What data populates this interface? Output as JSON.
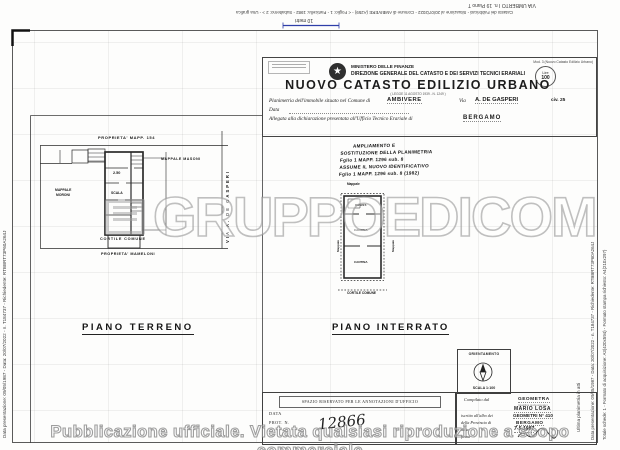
{
  "colors": {
    "scale_bar_blue": "#2e3ea8",
    "ink": "#1c1c1c",
    "watermark_gray": "#9a9a9a"
  },
  "icons": {
    "emblem_star": "★"
  },
  "margins": {
    "top_line1": "VIA UMBERTO I n. 19 Piano T",
    "top_line2": "Catasto dei Fabbricati - Situazione al 20/07/2022 - Comune di AMBIVERE (A259) - < Foglio: 1 - Particella: 1982 - Subalterno: 2 > - Una grafica",
    "scale_label": "10 metri",
    "left_vertical": "Data presentazione: 09/05/1987 - Data: 20/07/2022 - n. T184737 - Richiedente: RTBBRT73P60A264J",
    "right_vertical_1": "Ultima planimetria in atti",
    "right_vertical_2": "Data presentazione: 09/05/1987 - Data: 20/07/2022 - n. T184737 - Richiedente: RTBBRT73P60A264J",
    "right_vertical_3": "Totale schede: 1 - Formato di acquisizione: A3(420x594) - Formato stampa richiesto: A4(210x297)"
  },
  "header": {
    "ministry": "MINISTERO DELLE FINANZE",
    "direction": "DIREZIONE GENERALE DEL CATASTO E DEI SERVIZI TECNICI ERARIALI",
    "title": "NUOVO CATASTO EDILIZIO URBANO",
    "law_note": "( LEGGE 11 AGOSTO 1939 - N. 1249 )",
    "mod_label": "Mod. 3 (Nuovo Catasto Edilizio Urbano)",
    "lire_label": "Lire",
    "lire_value": "100",
    "f1_label": "Planimetria dell'immobile situato nel Comune di",
    "f1_comune": "AMBIVERE",
    "f1_via_label": "Via",
    "f1_via": "A. DE GASPERI",
    "f1_civ": "civ. 25",
    "f2_label": "Data",
    "f3_label": "Allegata alla dichiarazione presentata all'Ufficio Tecnico Erariale di",
    "f3_value": "BERGAMO"
  },
  "note": {
    "line1": "AMPLIAMENTO  E",
    "line2": "SOSTITUZIONE DELLA PLANIMETRIA",
    "line3": "Fglio 1   MAPP. 1296   sub. 8",
    "line4": "ASSUME IL NUOVO IDENTIFICATIVO",
    "line5": "Fglio 1   MAPP. 1296   sub. 8   (1982)"
  },
  "plan_terreno": {
    "top_label": "PROPRIETA' MAPP. 154",
    "right_label": "MAPPALE MASONI",
    "left_label_1": "MAPPALE",
    "left_label_2": "MORONI",
    "room_height": "2.50",
    "stair_label": "SCALA",
    "courtyard": "CORTILE COMUNE",
    "bottom_label": "PROPRIETA'  MAMELONI",
    "street": "VIA  A.  DE  GASPERI",
    "floor": "PIANO  TERRENO"
  },
  "plan_interrato": {
    "top_label": "Mappale",
    "room_top": "RIPOST.",
    "room_mid": "CANTINA",
    "room_low": "CANTINA",
    "side_left": "Mappale",
    "side_right": "Mappale",
    "bottom_label": "CORTILE COMUNE",
    "floor": "PIANO  INTERRATO"
  },
  "compass": {
    "title": "ORIENTAMENTO",
    "scale": "SCALA 1:100"
  },
  "office_box": {
    "title": "SPAZIO RISERVATO PER LE ANNOTAZIONI D'UFFICIO",
    "data_label": "DATA",
    "prot_label": "PROT. N.",
    "number": "12866"
  },
  "surveyor_box": {
    "c_label": "Compilato dal",
    "c_value": "GEOMETRA",
    "c_note": "(qualifica professionale)",
    "name": "MARIO LOSA",
    "albo_label": "iscritto all'albo dei",
    "albo_value": "GEOMETRI N° 410",
    "prov_label": "della Provincia di",
    "prov_value": "BERGAMO",
    "date_label": "data",
    "date_value": "7-5-1987",
    "sign_label": "firma"
  },
  "watermark": {
    "brand": "GRUPPOEDICOM",
    "bottom": "Pubblicazione ufficiale. Vietata qualsiasi riproduzione a scopo commerciale"
  }
}
